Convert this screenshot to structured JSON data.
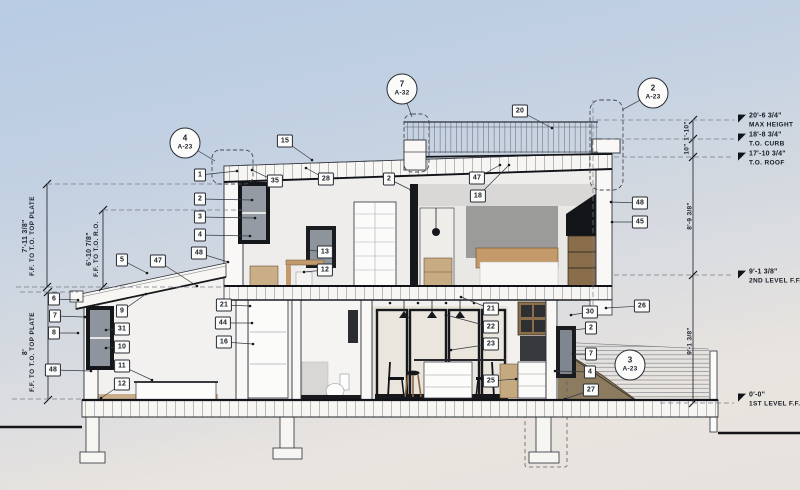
{
  "drawing": {
    "type": "building-section",
    "stories": 2
  },
  "colors": {
    "sky_top": "#b7cbe3",
    "sky_bottom": "#e9e4df",
    "ink": "#1b2027",
    "line": "#2b2f38",
    "soil": "#8c7b5f",
    "wood": "#c49a6a",
    "frame_dark": "#15161a",
    "tag_bg": "#fcfcfb",
    "wall_gray": "#d9d8d6",
    "glass": "#8e959e"
  },
  "left_dimensions": [
    {
      "value": "7'-11 3/8\"",
      "label": "F.F. TO T.O. TOP PLATE",
      "x": 29,
      "y": 236
    },
    {
      "value": "6'-10 7/8\"",
      "label": "F.F. TO T.O. R.O.",
      "x": 93,
      "y": 249
    },
    {
      "value": "8'",
      "label": "F.F. TO T.O. TOP PLATE",
      "x": 29,
      "y": 352
    }
  ],
  "right_dimensions": [
    {
      "value": "1'-10\"",
      "x": 687,
      "y": 131
    },
    {
      "value": "10\"",
      "x": 687,
      "y": 149
    },
    {
      "value": "8'-9 3/8\"",
      "x": 690,
      "y": 216
    },
    {
      "value": "9'-1 3/8\"",
      "x": 690,
      "y": 341
    }
  ],
  "elevation_markers": [
    {
      "value": "20'-6 3/4\"",
      "label": "MAX HEIGHT",
      "x": 738,
      "y": 121
    },
    {
      "value": "18'-8 3/4\"",
      "label": "T.O. CURB",
      "x": 738,
      "y": 140
    },
    {
      "value": "17'-10 3/4\"",
      "label": "T.O. ROOF",
      "x": 738,
      "y": 159
    },
    {
      "value": "9'-1 3/8\"",
      "label": "2ND LEVEL F.F.",
      "x": 738,
      "y": 277
    },
    {
      "value": "0'-0\"",
      "label": "1ST LEVEL F.F.",
      "x": 738,
      "y": 400
    }
  ],
  "detail_callouts": [
    {
      "number": "4",
      "sheet": "A-23",
      "x": 185,
      "y": 143,
      "tx": 215,
      "ty": 161
    },
    {
      "number": "7",
      "sheet": "A-32",
      "x": 402,
      "y": 89,
      "tx": 412,
      "ty": 117
    },
    {
      "number": "2",
      "sheet": "A-23",
      "x": 653,
      "y": 93,
      "tx": 622,
      "ty": 110
    },
    {
      "number": "3",
      "sheet": "A-23",
      "x": 630,
      "y": 365
    }
  ],
  "keynote_tags": [
    {
      "n": "1",
      "x": 200,
      "y": 175,
      "tx": 237,
      "ty": 171
    },
    {
      "n": "2",
      "x": 200,
      "y": 199,
      "tx": 252,
      "ty": 200
    },
    {
      "n": "3",
      "x": 200,
      "y": 217,
      "tx": 255,
      "ty": 218
    },
    {
      "n": "4",
      "x": 200,
      "y": 235,
      "tx": 250,
      "ty": 236
    },
    {
      "n": "48",
      "x": 199,
      "y": 253,
      "tx": 228,
      "ty": 262
    },
    {
      "n": "15",
      "x": 285,
      "y": 141,
      "tx": 312,
      "ty": 160
    },
    {
      "n": "35",
      "x": 275,
      "y": 181,
      "tx": 252,
      "ty": 170
    },
    {
      "n": "28",
      "x": 326,
      "y": 179,
      "tx": 306,
      "ty": 168
    },
    {
      "n": "2",
      "x": 389,
      "y": 179,
      "tx": 411,
      "ty": 190
    },
    {
      "n": "47",
      "x": 477,
      "y": 178,
      "tx": 500,
      "ty": 165
    },
    {
      "n": "18",
      "x": 478,
      "y": 196,
      "tx": 509,
      "ty": 165
    },
    {
      "n": "20",
      "x": 520,
      "y": 111,
      "tx": 552,
      "ty": 128
    },
    {
      "n": "48",
      "x": 640,
      "y": 203,
      "tx": 611,
      "ty": 202
    },
    {
      "n": "45",
      "x": 640,
      "y": 222,
      "tx": 612,
      "ty": 222
    },
    {
      "n": "26",
      "x": 642,
      "y": 306,
      "tx": 606,
      "ty": 308
    },
    {
      "n": "30",
      "x": 590,
      "y": 312,
      "tx": 571,
      "ty": 315
    },
    {
      "n": "2",
      "x": 591,
      "y": 328,
      "tx": 573,
      "ty": 330
    },
    {
      "n": "7",
      "x": 591,
      "y": 354,
      "tx": 573,
      "ty": 354
    },
    {
      "n": "4",
      "x": 590,
      "y": 372,
      "tx": 555,
      "ty": 371
    },
    {
      "n": "27",
      "x": 591,
      "y": 390,
      "tx": 565,
      "ty": 399
    },
    {
      "n": "5",
      "x": 122,
      "y": 260,
      "tx": 147,
      "ty": 273
    },
    {
      "n": "47",
      "x": 158,
      "y": 261,
      "tx": 197,
      "ty": 286
    },
    {
      "n": "6",
      "x": 54,
      "y": 299,
      "tx": 78,
      "ty": 300
    },
    {
      "n": "7",
      "x": 55,
      "y": 316,
      "tx": 85,
      "ty": 317
    },
    {
      "n": "8",
      "x": 54,
      "y": 333,
      "tx": 78,
      "ty": 333
    },
    {
      "n": "48",
      "x": 53,
      "y": 370,
      "tx": 91,
      "ty": 371
    },
    {
      "n": "9",
      "x": 122,
      "y": 311,
      "tx": 146,
      "ty": 294
    },
    {
      "n": "31",
      "x": 122,
      "y": 329,
      "tx": 106,
      "ty": 330
    },
    {
      "n": "10",
      "x": 122,
      "y": 347,
      "tx": 106,
      "ty": 348
    },
    {
      "n": "11",
      "x": 122,
      "y": 366,
      "tx": 152,
      "ty": 380
    },
    {
      "n": "12",
      "x": 122,
      "y": 384,
      "tx": 101,
      "ty": 398
    },
    {
      "n": "21",
      "x": 224,
      "y": 305,
      "tx": 250,
      "ty": 306
    },
    {
      "n": "44",
      "x": 223,
      "y": 323,
      "tx": 252,
      "ty": 323
    },
    {
      "n": "16",
      "x": 224,
      "y": 342,
      "tx": 253,
      "ty": 344
    },
    {
      "n": "13",
      "x": 325,
      "y": 252,
      "tx": 308,
      "ty": 250
    },
    {
      "n": "12",
      "x": 325,
      "y": 270,
      "tx": 304,
      "ty": 272
    },
    {
      "n": "21",
      "x": 491,
      "y": 309,
      "tx": 461,
      "ty": 297
    },
    {
      "n": "22",
      "x": 491,
      "y": 327,
      "tx": 446,
      "ty": 315
    },
    {
      "n": "23",
      "x": 491,
      "y": 344,
      "tx": 451,
      "ty": 350
    },
    {
      "n": "25",
      "x": 491,
      "y": 381,
      "tx": 516,
      "ty": 379
    }
  ]
}
